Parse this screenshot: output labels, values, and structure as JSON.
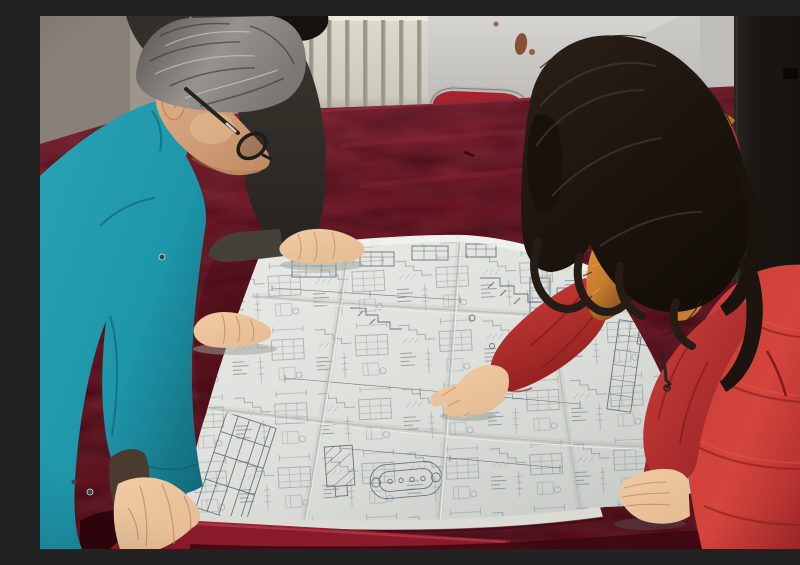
{
  "scene": {
    "title": "Workers reviewing an engineering blueprint",
    "description": "Photograph: a gray-haired man in a teal work jacket with glasses and a colleague in a dark jacket lean over a large folded engineering blueprint spread on a dark-red velvet table, while a woman in a red down coat with a fur-trimmed hood and long dark hair points at the drawing.",
    "people": [
      {
        "label": "man in teal work jacket",
        "hair": "gray",
        "accessories": "black-rimmed glasses",
        "action": "leaning over blueprint, hands on table"
      },
      {
        "label": "colleague in dark jacket",
        "hair": "black",
        "action": "hand resting on top edge of blueprint"
      },
      {
        "label": "woman in red down coat",
        "hair": "long dark brown",
        "accessories": "orange fur-trimmed hood",
        "action": "pointing at blueprint with index finger"
      }
    ],
    "objects": [
      {
        "label": "large folded engineering blueprint with dense technical drawings"
      },
      {
        "label": "table covered in dark red velvet cloth"
      },
      {
        "label": "stacking chair with red velvet back"
      },
      {
        "label": "cream wall radiator with vertical fins"
      },
      {
        "label": "white door panel with rust stains"
      },
      {
        "label": "dark doorway at right"
      }
    ]
  },
  "colors": {
    "wall": "#9b958c",
    "radiator": "#ddd9cd",
    "radiator_fin": "#a39e94",
    "door": "#d6d5d1",
    "doorway_dark": "#1a1713",
    "rust": "#7d3a1c",
    "chair_red": "#a82330",
    "chair_metal": "#b5b6b2",
    "velvet": "#6e1120",
    "velvet_light": "#8d2738",
    "velvet_dark": "#3c0710",
    "paper": "#e9ebe6",
    "paper_shade": "#c7cbc6",
    "ink": "#6d7889",
    "teal_light": "#2aa3b5",
    "teal": "#1e96aa",
    "teal_dark": "#10606f",
    "jacket_dark": "#3b362f",
    "hair_gray_light": "#96928d",
    "hair_gray_dark": "#55524d",
    "skin_light": "#f0cba2",
    "skin": "#e6bd94",
    "skin_shadow": "#c08a62",
    "face": "#ddae88",
    "coat_light": "#d4453c",
    "coat_red": "#c73a36",
    "coat_shadow": "#8e1f24",
    "fur_orange": "#c87c2e",
    "fur_dark": "#5e3c16",
    "woman_hair": "#1e1610",
    "woman_hair_sheen": "#4e3b28"
  }
}
